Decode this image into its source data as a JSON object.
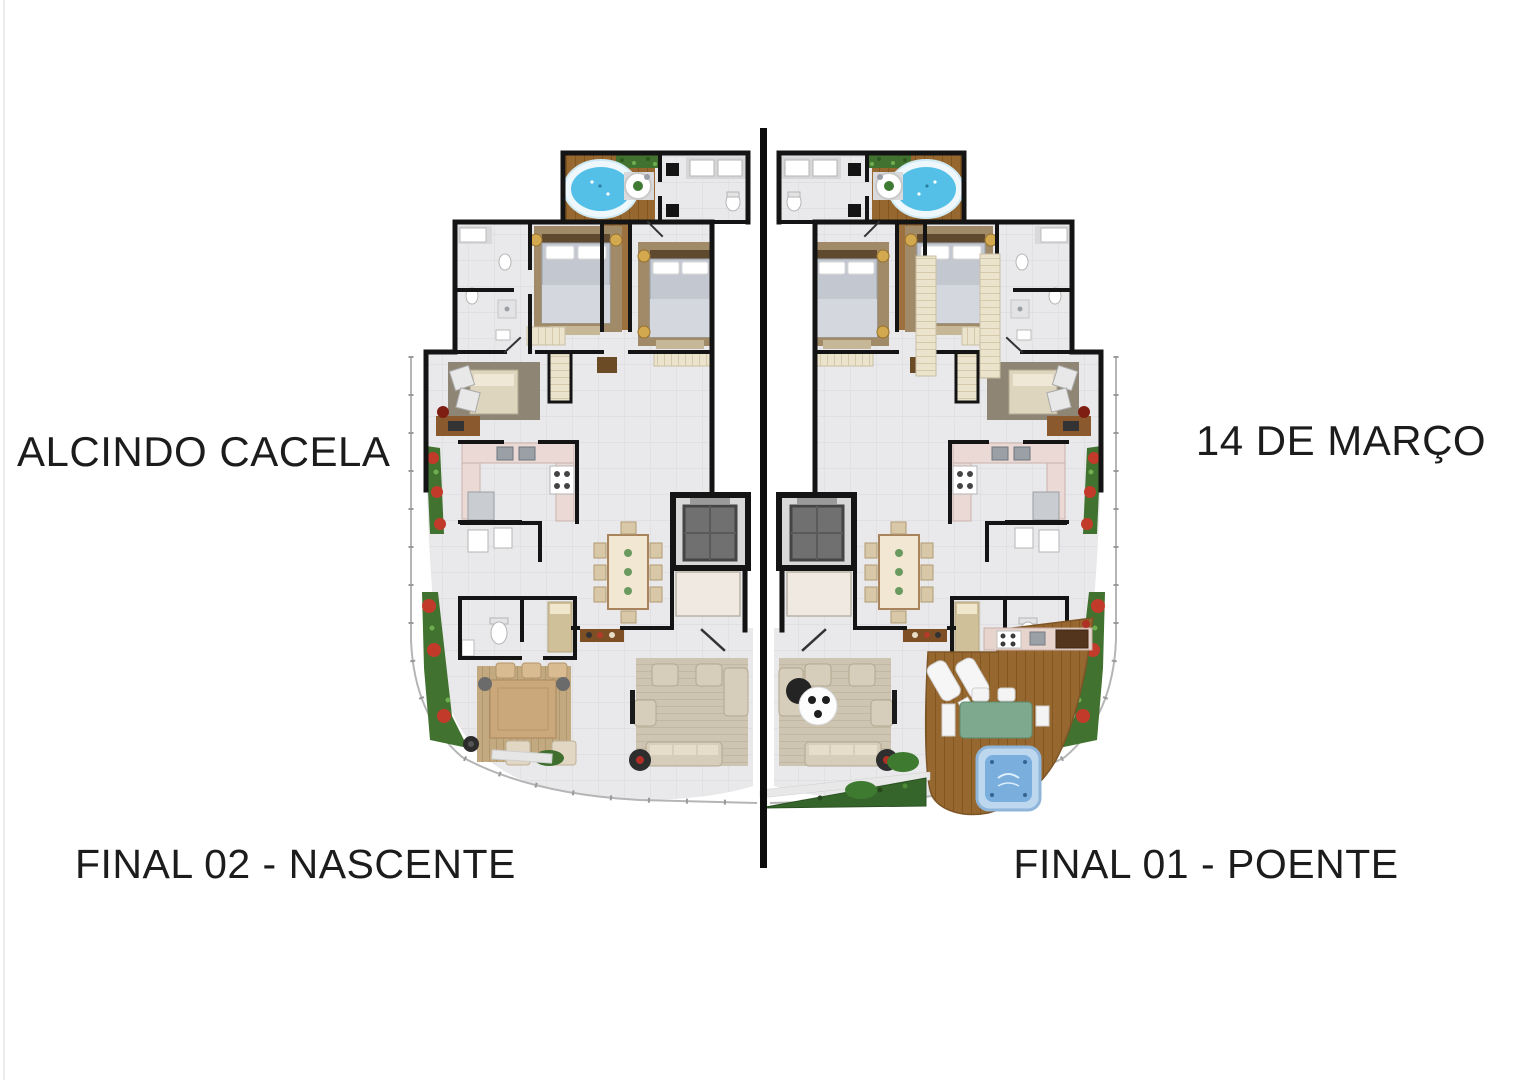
{
  "labels": {
    "street_left": "ALCINDO CACELA",
    "street_right": "14 DE MARÇO",
    "unit_left": "FINAL 02 - NASCENTE",
    "unit_right": "FINAL 01 - POENTE"
  },
  "palette": {
    "wall": "#141414",
    "divider": "#0c0c0c",
    "floor": "#e9e9eb",
    "floor_line": "#dcdcdf",
    "wood": "#96672f",
    "wood_line": "#82561f",
    "jacuzzi": "#54c0e8",
    "spa": "#79aedd",
    "plant": "#41722f",
    "flower": "#c23b2a",
    "rug": "#cdc4b2",
    "rug_terrace": "#c2a980",
    "sofa": "#d7cdbb",
    "counter": "#ead9d4",
    "elevator": "#707070",
    "bed": "#c3c7cf",
    "shelf": "#ece3cc",
    "table": "#f2e7d3",
    "green_table": "#7fa98e",
    "railing": "#b5b5b5",
    "label_text": "#1c1c1c"
  }
}
